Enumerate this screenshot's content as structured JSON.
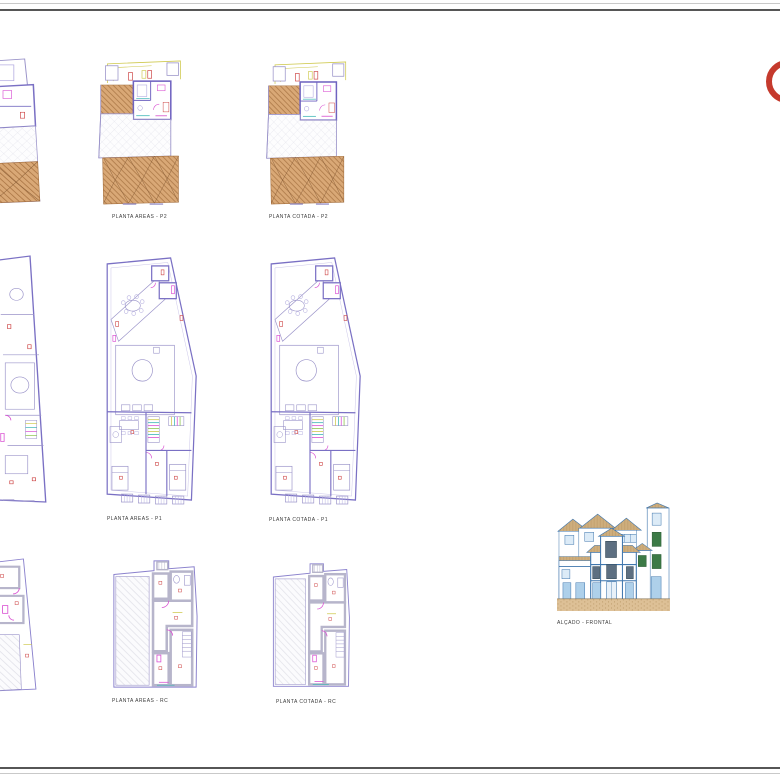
{
  "sheet": {
    "kind": "architectural drawing sheet",
    "background": "#ffffff",
    "border_dark": "#565656",
    "border_light": "#c9c9c9"
  },
  "labels": {
    "areas_p2": "PLANTA AREAS - P2",
    "cotada_p2": "PLANTA COTADA - P2",
    "areas_p1": "PLANTA AREAS - P1",
    "cotada_p1": "PLANTA COTADA - P1",
    "areas_rc": "PLANTA AREAS - RC",
    "cotada_rc": "PLANTA COTADA - RC",
    "elevation": "ALÇADO - FRONTAL"
  },
  "logo": {
    "shape": "red ring, clipped at right sheet edge",
    "color": "#c53a2d"
  },
  "colors": {
    "wall_purple": "#7a70c4",
    "outline_purple": "#9a93c9",
    "poche_gray": "#b7b5cb",
    "deck_wood": "#d9a876",
    "deck_line": "#a5703f",
    "accent_magenta": "#d94fd2",
    "accent_red": "#cc4040",
    "accent_yellow": "#cfc94e",
    "accent_cyan": "#3ab5b5",
    "facade_blue": "#3f76ad",
    "facade_pale_blue": "#dcebf7",
    "facade_door_blue": "#aed0ea",
    "facade_window_dark": "#5d6f81",
    "shutter_green": "#3c7a46",
    "roof_tan": "#d9b98a",
    "ground_sand": "#ddc096"
  }
}
